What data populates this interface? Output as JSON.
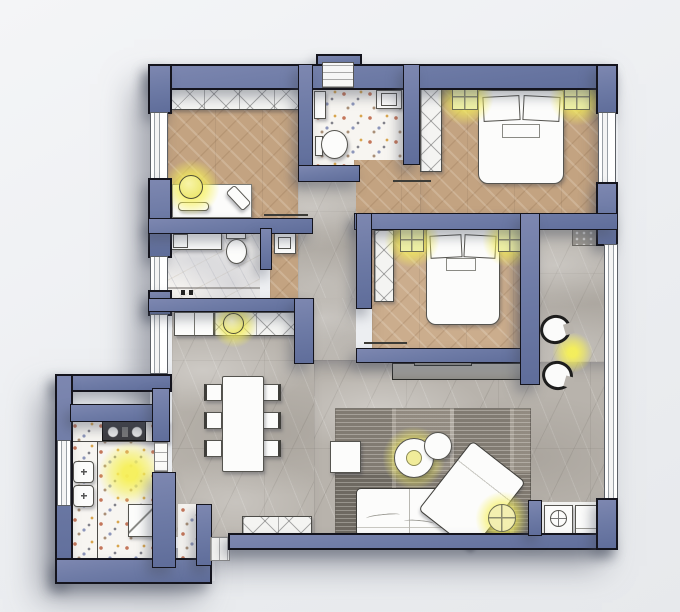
{
  "meta": {
    "image_type": "apartment floor plan rendering, top-down",
    "canvas": {
      "width": 680,
      "height": 612
    },
    "no_visible_text": true
  },
  "palette": {
    "background": "#eef0f2",
    "wall_fill": "#6e7ba6",
    "wall_outline": "#14141d",
    "wood_floor": "#c3a381",
    "wood_floor_light": "#cbad8d",
    "marble_gray_floor": "#b8b3ac",
    "marble_white_floor": "#f3f1ee",
    "terrazzo_floor": "#f7f5f1",
    "rug": "#8f897f",
    "furniture_white": "#fcfcfb",
    "light_glow": "#f4ee58"
  },
  "rooms": [
    {
      "id": "office",
      "label": "bedroom-office",
      "floor": "wood-herringbone",
      "furniture": [
        "wardrobe-top",
        "desk",
        "laptop",
        "keyboard",
        "desk-lamp"
      ]
    },
    {
      "id": "bathroom",
      "label": "bathroom",
      "floor": "terrazzo-marble",
      "furniture": [
        "washbasin",
        "toilet",
        "shelf"
      ]
    },
    {
      "id": "bedroom1",
      "label": "bedroom-1",
      "floor": "wood-herringbone",
      "furniture": [
        "double-bed",
        "pillows-x2",
        "wardrobe",
        "ceiling-light-x2"
      ]
    },
    {
      "id": "bedroom2",
      "label": "bedroom-2",
      "floor": "wood-herringbone",
      "furniture": [
        "double-bed",
        "pillows-x2",
        "wardrobe",
        "ceiling-light-x2",
        "console-below-wall"
      ]
    },
    {
      "id": "wc",
      "label": "wc-shower",
      "floor": "white-marble",
      "furniture": [
        "vanity-sink",
        "toilet",
        "shower-fittings",
        "hall-washbasin"
      ]
    },
    {
      "id": "hallway",
      "label": "entry-hall",
      "floor": "gray-marble",
      "furniture": [
        "closet-cabinet",
        "sideboard",
        "decor-lamp"
      ]
    },
    {
      "id": "kitchen",
      "label": "kitchen",
      "floor": "terrazzo",
      "furniture": [
        "hob-2-burner",
        "double-sink",
        "counter-L",
        "fridge",
        "pantry"
      ]
    },
    {
      "id": "living",
      "label": "living-dining",
      "floor": "gray-marble",
      "furniture": [
        "dining-table",
        "dining-chairs-x6",
        "area-rug",
        "sectional-sofa",
        "chaise",
        "coffee-table",
        "round-side-table",
        "square-side-table",
        "floor-lamp",
        "tub-chairs-x2",
        "bench",
        "doormat",
        "washing-machine",
        "dryer"
      ]
    }
  ],
  "lights": [
    {
      "room": "office",
      "kind": "desk-lamp",
      "approx": [
        191,
        187
      ]
    },
    {
      "room": "bedroom1",
      "kind": "ceiling-square",
      "approx": [
        465,
        97
      ]
    },
    {
      "room": "bedroom1",
      "kind": "ceiling-square",
      "approx": [
        577,
        97
      ]
    },
    {
      "room": "bedroom2",
      "kind": "ceiling-square",
      "approx": [
        412,
        240
      ]
    },
    {
      "room": "bedroom2",
      "kind": "ceiling-square",
      "approx": [
        510,
        240
      ]
    },
    {
      "room": "hallway",
      "kind": "decor-lamp",
      "approx": [
        234,
        324
      ]
    },
    {
      "room": "kitchen",
      "kind": "ceiling",
      "approx": [
        130,
        473
      ]
    },
    {
      "room": "living",
      "kind": "coffee-table",
      "approx": [
        414,
        458
      ]
    },
    {
      "room": "living",
      "kind": "floor-lamp",
      "approx": [
        502,
        518
      ]
    },
    {
      "room": "living",
      "kind": "between-chairs",
      "approx": [
        572,
        352
      ]
    }
  ],
  "windows": [
    "left-office",
    "left-wc",
    "left-entry",
    "left-kitchen",
    "right-bedroom1",
    "right-living-long"
  ],
  "doors": [
    "office-open-leaf",
    "bathroom-open-leaf",
    "bedroom2-open-leaf",
    "kitchen-opening",
    "balcony-gap-bottom"
  ]
}
